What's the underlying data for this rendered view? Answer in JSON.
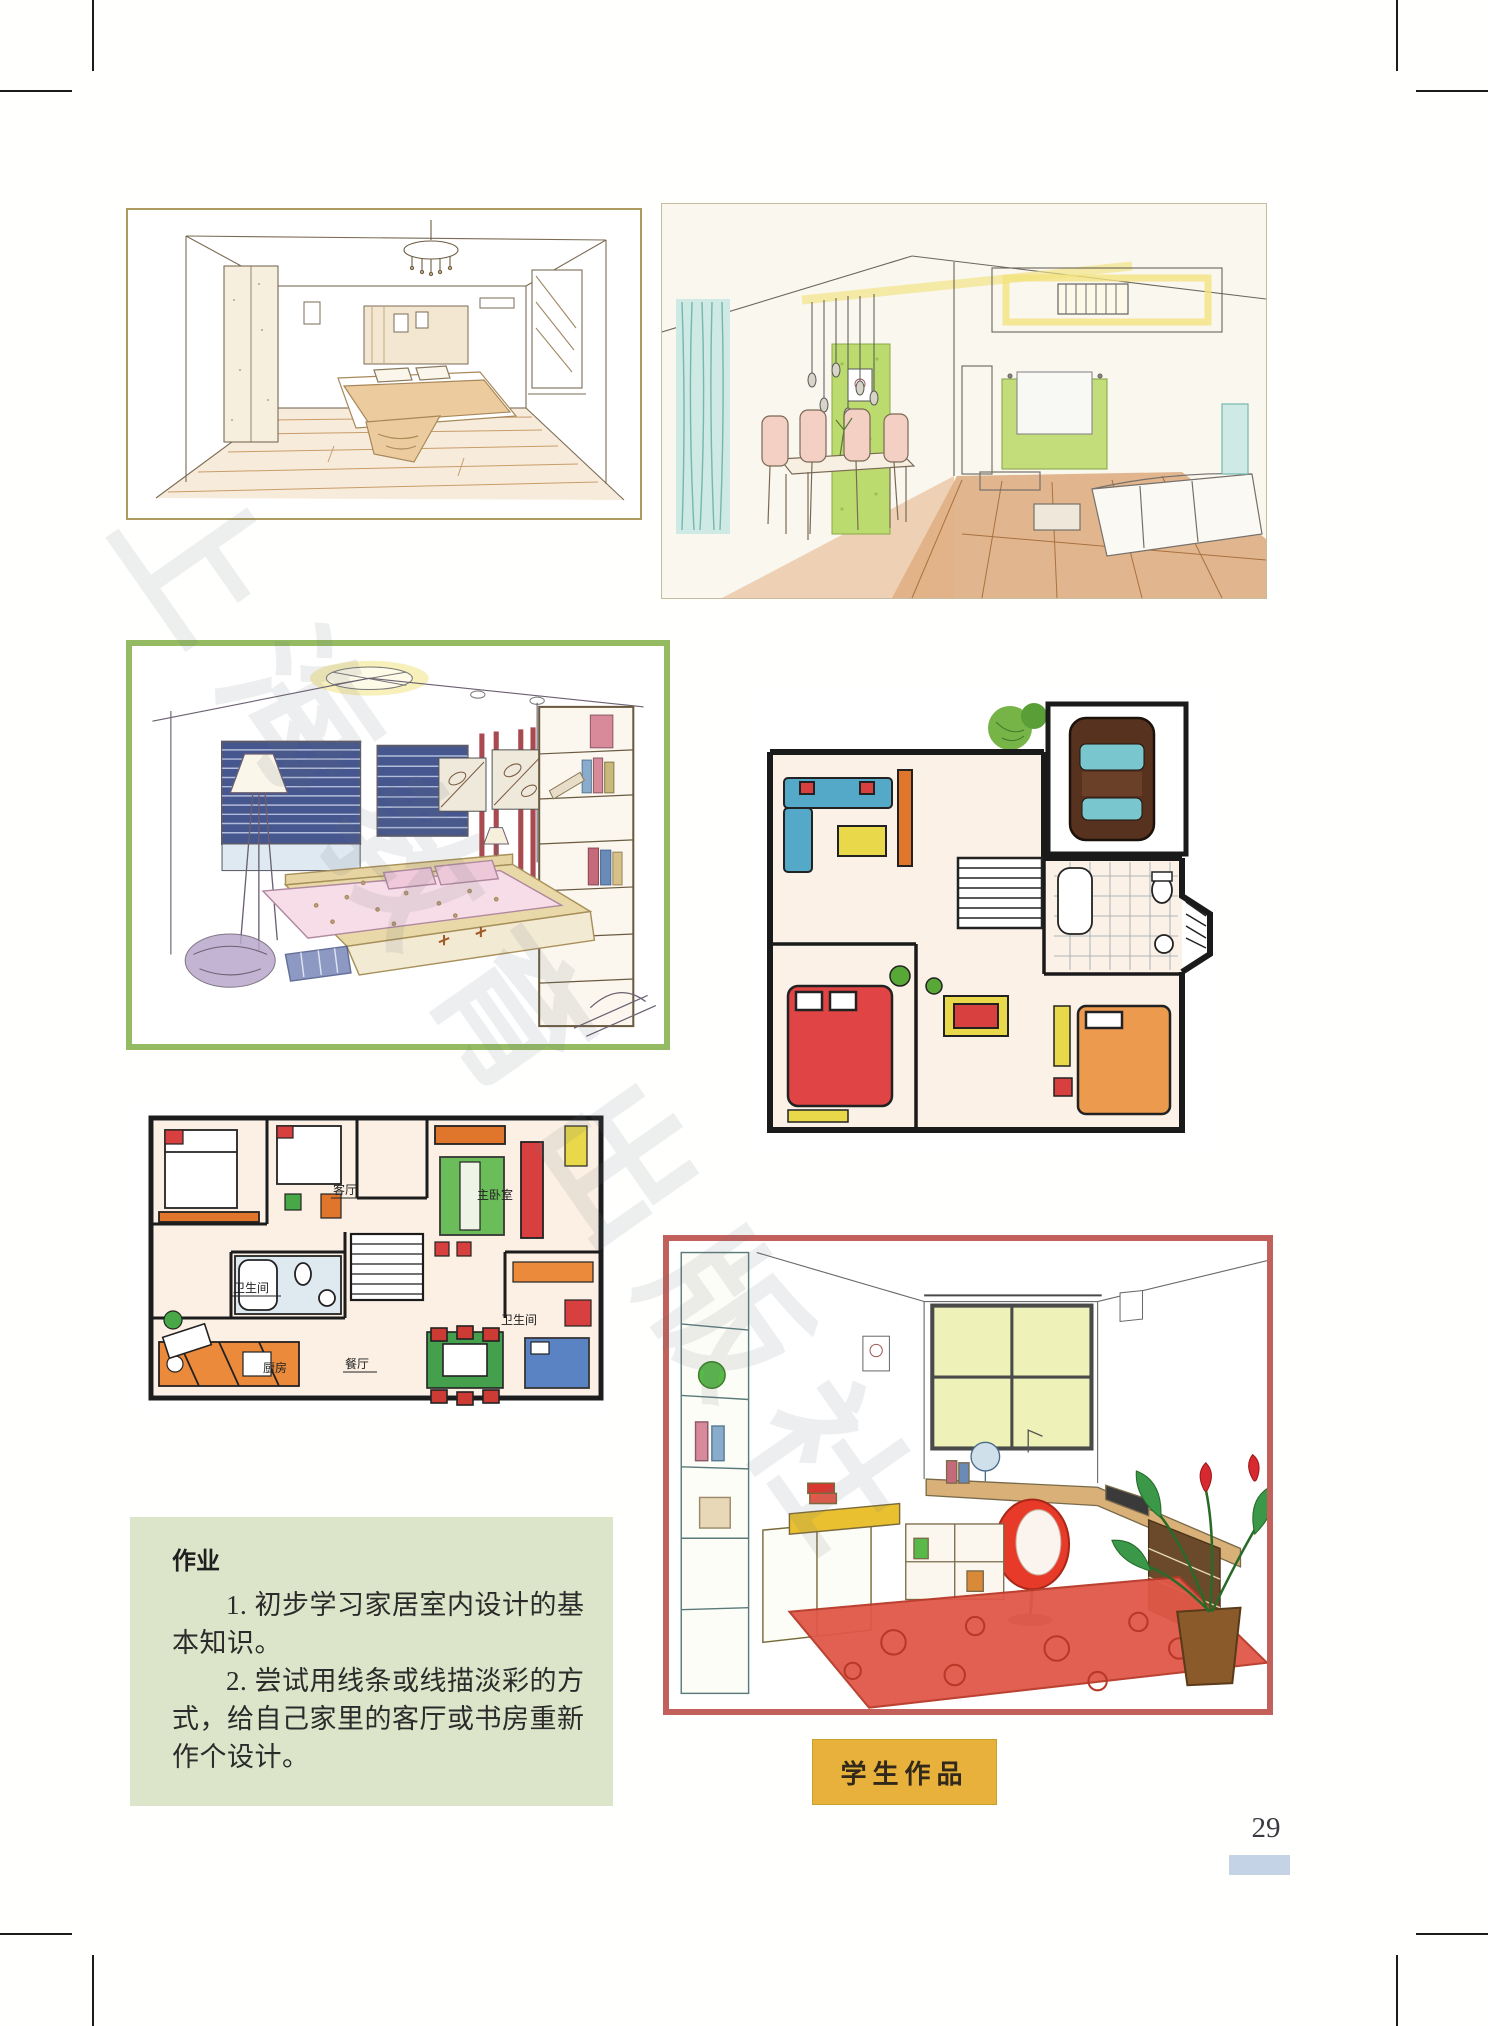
{
  "page": {
    "number": "29"
  },
  "assignment": {
    "title": "作业",
    "lines": [
      "1. 初步学习家居室内设计的基",
      "本知识。",
      "2. 尝试用线条或线描淡彩的方",
      "式，给自己家里的客厅或书房重新",
      "作个设计。"
    ]
  },
  "student_label": {
    "text": "学生作品"
  },
  "watermark": {
    "text": "上海教育出版社"
  },
  "plan_labels": {
    "living": "客厅",
    "master_bedroom": "主卧室",
    "bath_1": "卫生间",
    "bath_2": "卫生间",
    "kitchen": "厨房",
    "dining": "餐厅"
  },
  "colors": {
    "assignment_bg": "#dce5c9",
    "label_bg": "#e7b13b",
    "page_bar": "#c5d3e7",
    "frame_green": "#94bb62",
    "frame_red": "#c2605b",
    "frame_tan": "#ac9a5e"
  }
}
